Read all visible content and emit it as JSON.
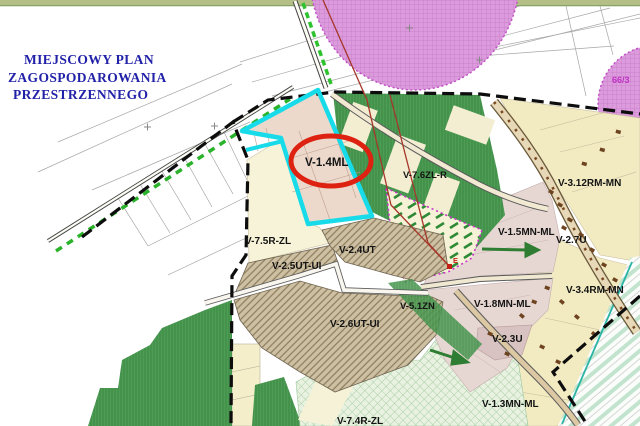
{
  "map": {
    "title_lines": [
      "MIEJSCOWY PLAN",
      "ZAGOSPODAROWANIA",
      "PRZESTRZENNEGO"
    ],
    "highlighted_zone": "V-1.4ML",
    "zones": [
      {
        "label": "V-1.4ML"
      },
      {
        "label": "V-7.6ZL-R"
      },
      {
        "label": "V-3.12RM-MN"
      },
      {
        "label": "V-1.5MN-ML"
      },
      {
        "label": "V-2.7U"
      },
      {
        "label": "V-7.5R-ZL"
      },
      {
        "label": "V-2.5UT-UI"
      },
      {
        "label": "V-2.4UT"
      },
      {
        "label": "V-2.6UT-UI"
      },
      {
        "label": "V-5.1ZN"
      },
      {
        "label": "V-1.8MN-ML"
      },
      {
        "label": "V-3.4RM-MN"
      },
      {
        "label": "V-2.3U"
      },
      {
        "label": "V-1.3MN-ML"
      },
      {
        "label": "V-7.4R-ZL"
      }
    ],
    "parcel_number": "66/3",
    "marker_e": "E",
    "colors": {
      "title_text": "#2222a8",
      "highlight_circle": "#dd2211",
      "selection_outline_cyan": "#17dbe8",
      "plan_boundary": "#111111",
      "forest_green": "#4d9c54",
      "zone_yellow": "#f2ebc2",
      "zone_pink": "#e7d7d2",
      "zone_brown_hatch": "#cdc0a3",
      "zone_cream": "#f6f2d8",
      "protection_zone_magenta": "#db9bdc",
      "power_line_red": "#a5382a",
      "wetland_stripe_green": "#c2e4cf"
    }
  }
}
